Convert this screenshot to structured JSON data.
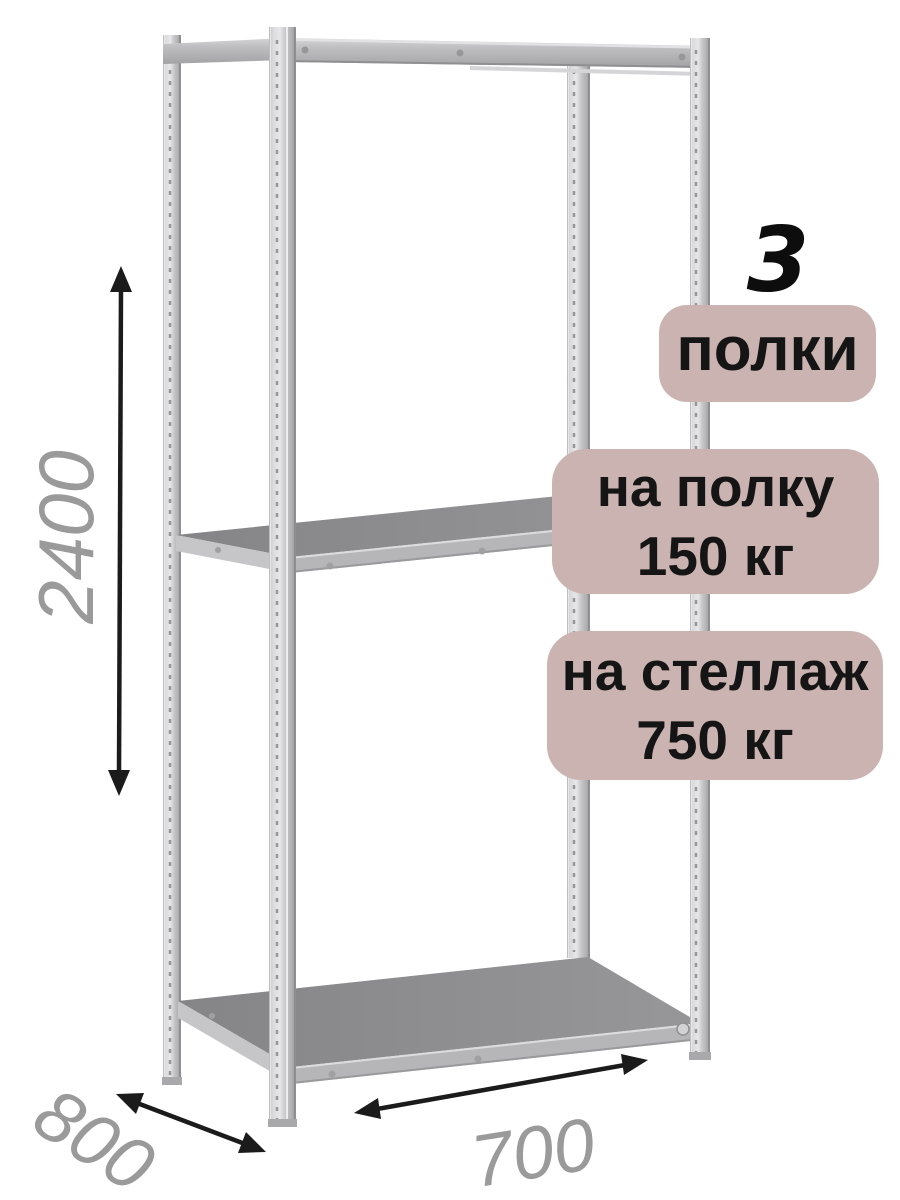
{
  "badges": {
    "count": {
      "number": "3",
      "label": "полки"
    },
    "shelf_load": {
      "line1": "на полку",
      "line2": "150 кг"
    },
    "rack_load": {
      "line1": "на стеллаж",
      "line2": "750 кг"
    }
  },
  "dimensions": {
    "height": "2400",
    "depth": "800",
    "width": "700"
  },
  "icons": {
    "height_arrow": "double-headed-arrow-vertical",
    "depth_arrow": "double-headed-arrow-diagonal",
    "width_arrow": "double-headed-arrow-horizontal"
  },
  "colors": {
    "badge_bg": "#cab3b1",
    "badge_text": "#151515",
    "dimension_text": "#9a9a9a",
    "arrow": "#1b1b1b",
    "rack_metal_light": "#d9d9db",
    "rack_metal_dark": "#939395",
    "shelf_surface": "#8c8c8e",
    "background": "#ffffff"
  }
}
